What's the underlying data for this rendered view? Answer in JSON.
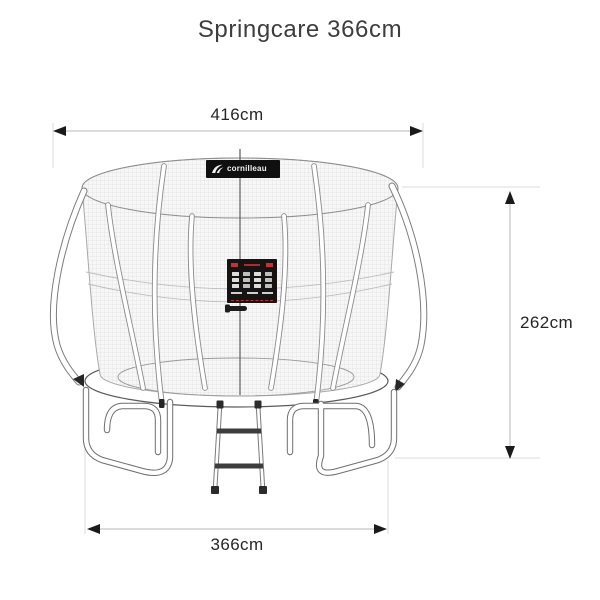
{
  "title": "Springcare 366cm",
  "brand": {
    "logo_text": "cornilleau"
  },
  "dimensions": {
    "top_width": {
      "label": "416cm"
    },
    "height": {
      "label": "262cm"
    },
    "base_width": {
      "label": "366cm"
    }
  },
  "illustration": {
    "product": "trampoline with safety enclosure net and ladder",
    "parts": [
      "safety-net",
      "net-rim",
      "enclosure-poles",
      "frame-pad",
      "jumping-mat",
      "w-legs",
      "ladder",
      "entrance-zipper",
      "safety-sticker",
      "brand-banner"
    ]
  },
  "colors": {
    "background": "#ffffff",
    "line_gray": "#6b6b6b",
    "mesh_gray": "#d6d6d6",
    "dimension_line": "#cfcfcf",
    "arrowhead": "#1a1a1a",
    "banner_black": "#101010",
    "label_red": "#c43232"
  }
}
